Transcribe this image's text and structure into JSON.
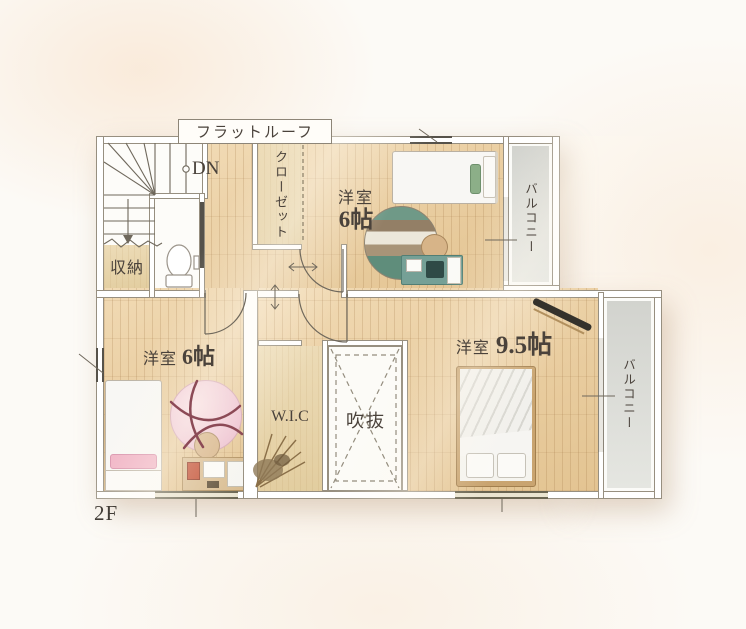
{
  "floorplan": {
    "floor_label": "2F",
    "roof_label": "フラットルーフ",
    "stairs_down_label": "DN",
    "storage_label": "収納",
    "closet_label": "クローゼット",
    "wic_label": "W.I.C",
    "void_label": "吹抜",
    "balcony_top_label": "バルコニー",
    "balcony_right_label": "バルコニー",
    "bedroom_top": {
      "name": "洋室",
      "size": "6帖"
    },
    "bedroom_left": {
      "name": "洋室",
      "size": "6帖"
    },
    "bedroom_main": {
      "name": "洋室",
      "size": "9.5帖"
    },
    "colors": {
      "wood_floor": "#e9cda0",
      "closet_floor": "#e6d3aa",
      "balcony_floor": "#d9dad4",
      "wall_line": "#978f80",
      "text": "#4a423b",
      "rug_green": "#6f9987",
      "rug_pink": "#eec3d2",
      "desk_teal": "#75a096"
    }
  }
}
